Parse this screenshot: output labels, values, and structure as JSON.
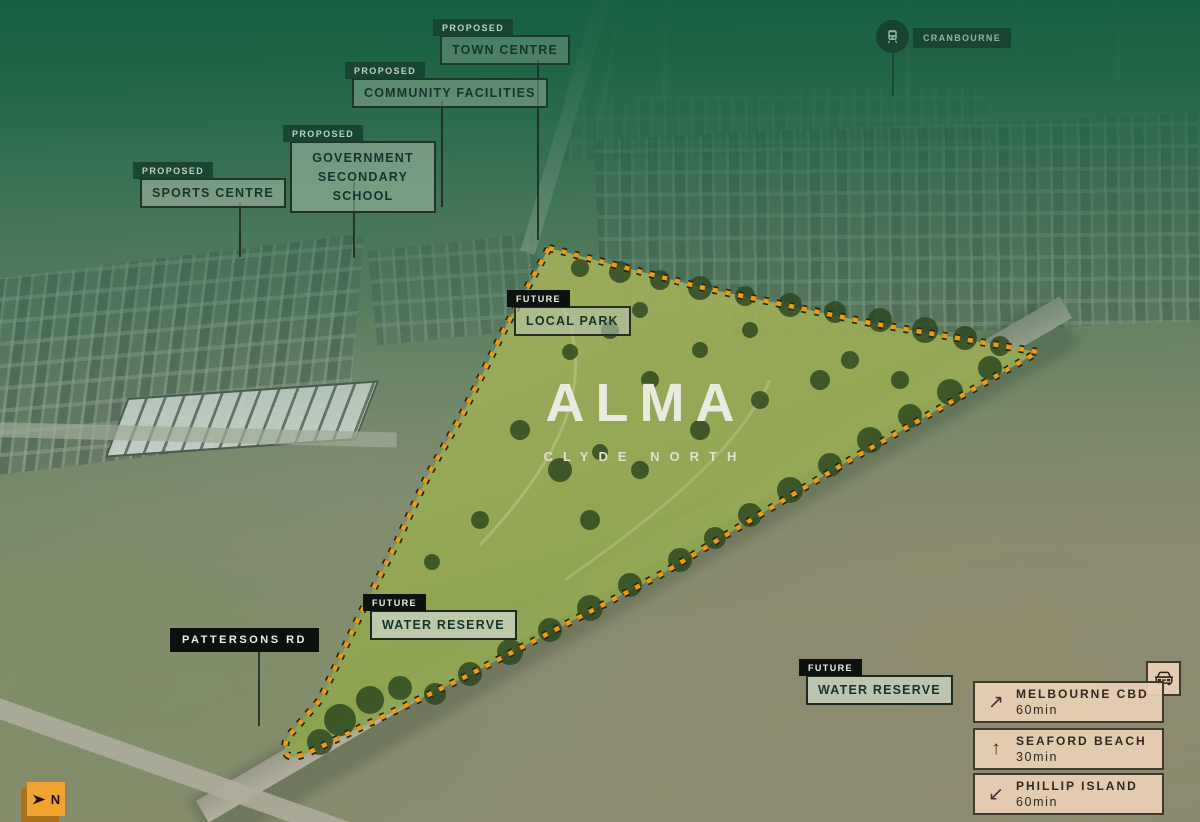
{
  "site": {
    "name": "ALMA",
    "locality": "CLYDE NORTH"
  },
  "callouts": {
    "town_centre": {
      "tag": "PROPOSED",
      "label": "TOWN CENTRE"
    },
    "community_facilities": {
      "tag": "PROPOSED",
      "label": "COMMUNITY FACILITIES"
    },
    "secondary_school": {
      "tag": "PROPOSED",
      "label": "GOVERNMENT SECONDARY SCHOOL"
    },
    "sports_centre": {
      "tag": "PROPOSED",
      "label": "SPORTS CENTRE"
    },
    "local_park": {
      "tag": "FUTURE",
      "label": "LOCAL PARK"
    },
    "water_reserve_west": {
      "tag": "FUTURE",
      "label": "WATER RESERVE"
    },
    "water_reserve_east": {
      "tag": "FUTURE",
      "label": "WATER RESERVE"
    }
  },
  "road_label": "PATTERSONS RD",
  "station": {
    "label": "CRANBOURNE",
    "icon": "train-icon"
  },
  "travel": {
    "icon": "car-icon",
    "items": [
      {
        "arrow": "↗",
        "direction": "north-east",
        "destination": "MELBOURNE CBD",
        "time": "60min"
      },
      {
        "arrow": "↑",
        "direction": "north",
        "destination": "SEAFORD BEACH",
        "time": "30min"
      },
      {
        "arrow": "↙",
        "direction": "south-west",
        "destination": "PHILLIP ISLAND",
        "time": "60min"
      }
    ]
  },
  "compass": {
    "label": "N",
    "icon": "north-arrow-icon"
  },
  "colors": {
    "boundary_orange": "#F5990F",
    "boundary_outline": "#1E2A1E",
    "overlay_green": "#156040",
    "tag_green": "#1A4432",
    "tag_black": "#0D120E",
    "panel_beige": "#E9D0B4",
    "compass_orange": "#F2A230"
  }
}
